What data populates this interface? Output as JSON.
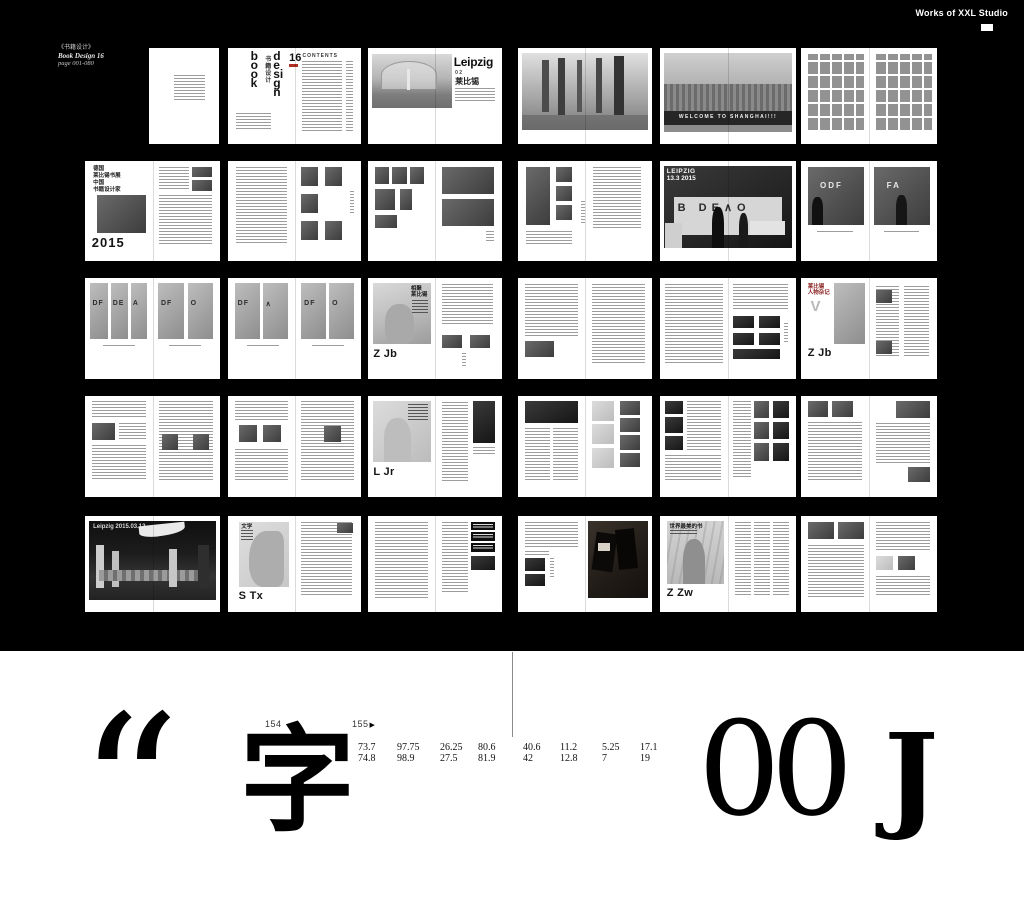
{
  "site": {
    "title": "Works of XXL Studio"
  },
  "project": {
    "title_cn": "《书籍设计》",
    "title_en": "Book Design 16",
    "page_range": "page 001-080"
  },
  "spreads": {
    "book_design": {
      "word1": "book",
      "word2": "design",
      "number": "16",
      "cn": "书籍设计",
      "contents": "CONTENTS"
    },
    "leipzig_chapter": {
      "title": "Leipzig",
      "chapter_no": "0 2",
      "title_cn": "莱比锡"
    },
    "welcome": {
      "banner": "WELCOME TO SHANGHAI!!!"
    },
    "expo2015": {
      "l1": "德国",
      "l2": "莱比锡书展",
      "l3": "中国",
      "l4": "书籍设计家",
      "year": "2015"
    },
    "booth": {
      "l1": "LEIPZIG",
      "l2": "13.3 2015",
      "letters": "B DE∧O"
    },
    "booth_pair": {
      "left_letters": "ODF",
      "right_letters": "FA"
    },
    "strips1": {
      "letters": [
        "DF",
        "DE",
        "A",
        "DF",
        "O"
      ]
    },
    "strips2": {
      "letters": [
        "DF",
        "∧",
        "DF",
        "O"
      ]
    },
    "zjb": {
      "h1": "相聚",
      "h2": "莱比锡",
      "name": "Z Jb"
    },
    "zjb_notes": {
      "h1": "莱比锡",
      "h2": "人物杂记",
      "letter": "V",
      "name": "Z Jb"
    },
    "ljr": {
      "name": "L Jr"
    },
    "hall": {
      "caption": "Leipzig 2015.03.12"
    },
    "stx": {
      "heading": "文学",
      "name": "S Tx"
    },
    "zzw": {
      "heading": "世界最美的书",
      "name": "Z Zw"
    }
  },
  "footer": {
    "page_left": "154",
    "page_right": "155",
    "next_arrow": "▶",
    "measurements": [
      {
        "top": "73.7",
        "bottom": "74.8"
      },
      {
        "top": "97.75",
        "bottom": "98.9"
      },
      {
        "top": "26.25",
        "bottom": "27.5"
      },
      {
        "top": "80.6",
        "bottom": "81.9"
      },
      {
        "top": "40.6",
        "bottom": "42"
      },
      {
        "top": "11.2",
        "bottom": "12.8"
      },
      {
        "top": "5.25",
        "bottom": "7"
      },
      {
        "top": "17.1",
        "bottom": "19"
      }
    ],
    "glyphs": {
      "quote": "“",
      "char": "字",
      "zeros": "00",
      "letter": "J"
    }
  },
  "colors": {
    "background": "#000000",
    "page": "#ffffff",
    "accent_red": "#8b2222"
  }
}
